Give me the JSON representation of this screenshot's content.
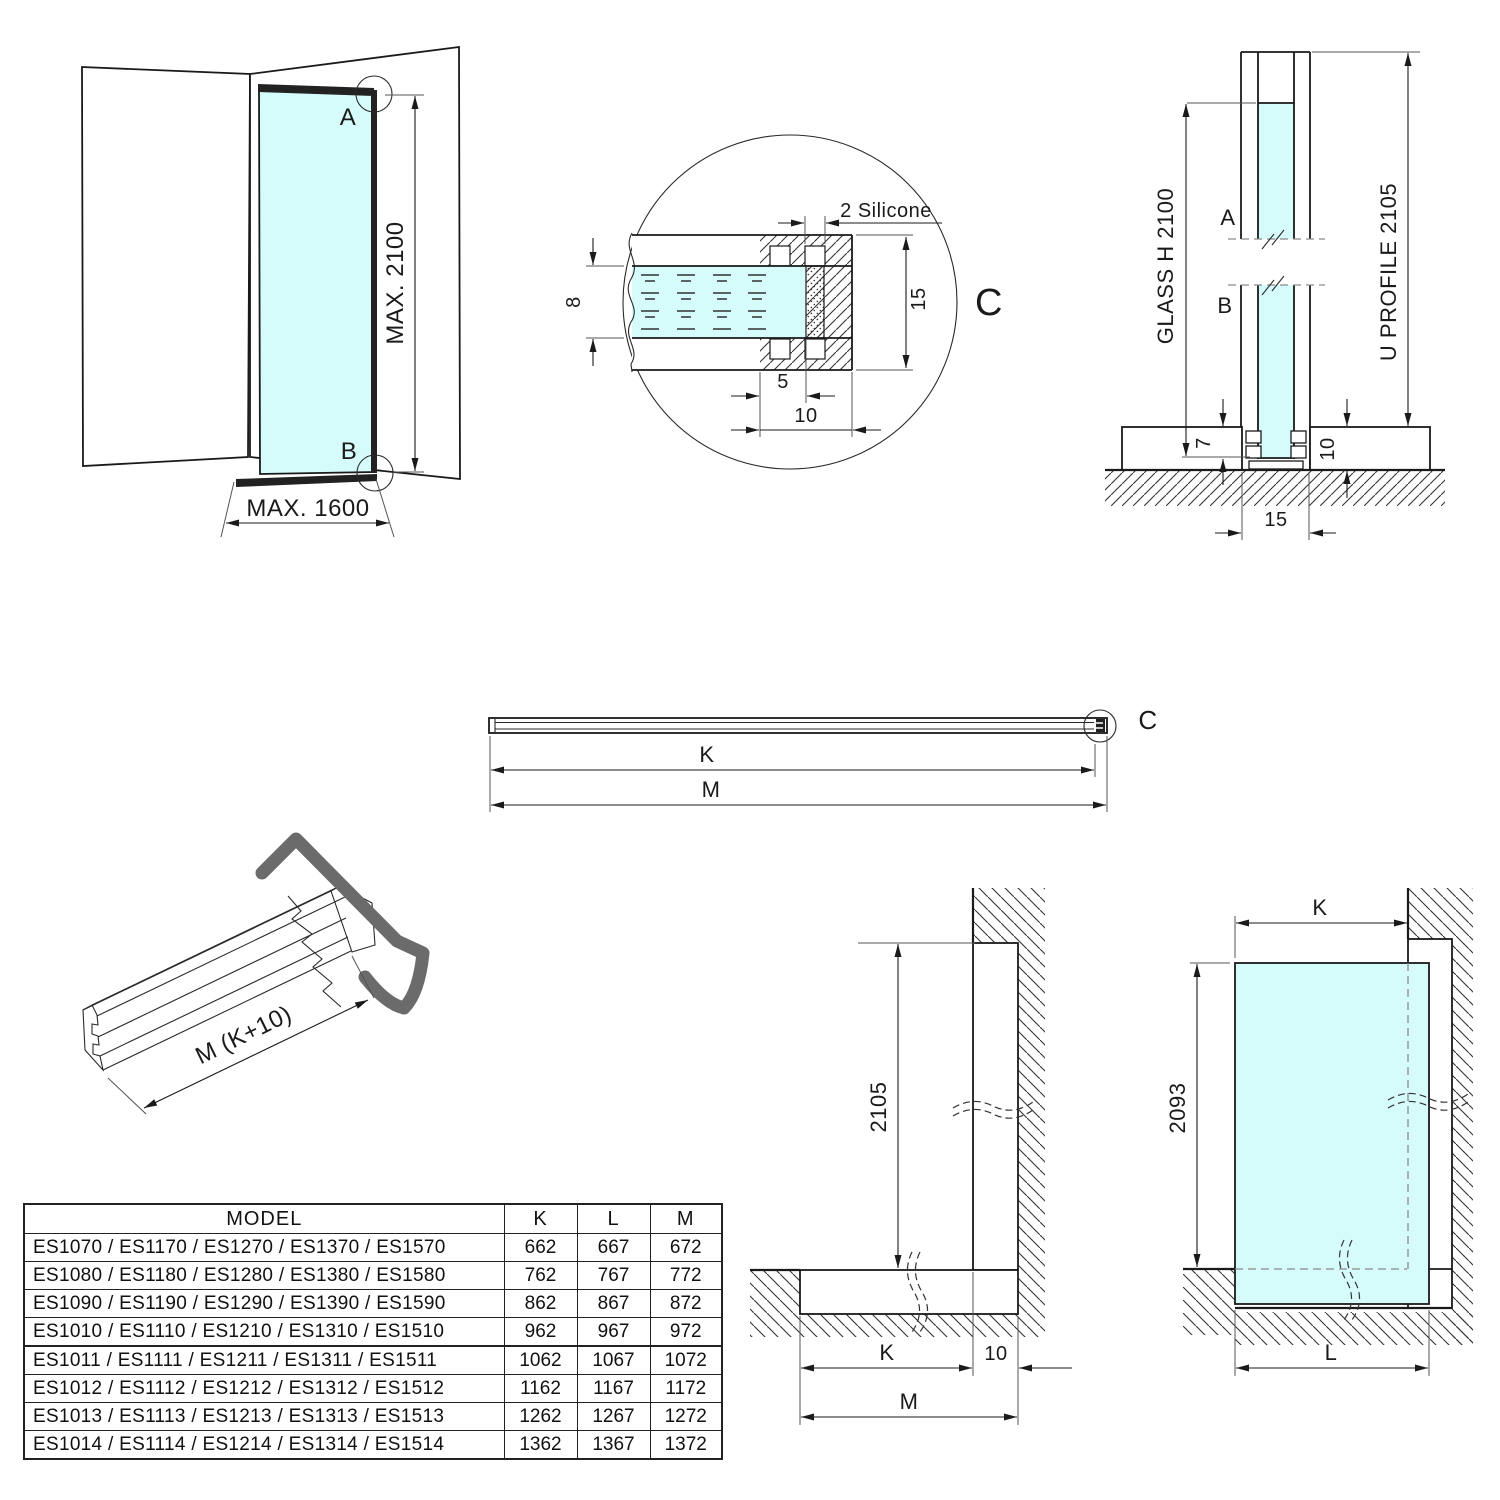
{
  "colors": {
    "glass": "#d5fbfb",
    "line": "#1a1a1a",
    "profile_gray": "#6b6b6b"
  },
  "views": {
    "corner": {
      "label_a": "A",
      "label_b": "B",
      "dim_height": "MAX. 2100",
      "dim_width": "MAX. 1600"
    },
    "detail": {
      "silicone": "2 Silicone",
      "dim_glass": "8",
      "dim_height": "15",
      "dim_inner": "5",
      "dim_outer": "10",
      "letter": "C"
    },
    "side": {
      "label_a": "A",
      "label_b": "B",
      "dim_glass": "GLASS H 2100",
      "dim_profile": "U PROFILE 2105",
      "dim_7": "7",
      "dim_10": "10",
      "dim_15": "15"
    },
    "bar": {
      "dim_k": "K",
      "dim_m": "M",
      "letter": "C"
    },
    "iso": {
      "dim_length": "M (K+10)"
    },
    "wall_section": {
      "dim_height": "2105",
      "dim_k": "K",
      "dim_10": "10",
      "dim_m": "M"
    },
    "glass_elev": {
      "dim_k": "K",
      "dim_height": "2093",
      "dim_l": "L"
    }
  },
  "table": {
    "headers": [
      "MODEL",
      "K",
      "L",
      "M"
    ],
    "rows": [
      {
        "model": "ES1070 / ES1170 / ES1270 / ES1370 / ES1570",
        "k": "662",
        "l": "667",
        "m": "672"
      },
      {
        "model": "ES1080 / ES1180 / ES1280 / ES1380 / ES1580",
        "k": "762",
        "l": "767",
        "m": "772"
      },
      {
        "model": "ES1090 / ES1190 / ES1290 / ES1390 / ES1590",
        "k": "862",
        "l": "867",
        "m": "872"
      },
      {
        "model": "ES1010 / ES1110 / ES1210 / ES1310 / ES1510",
        "k": "962",
        "l": "967",
        "m": "972"
      },
      {
        "model": "ES1011 / ES1111 / ES1211 / ES1311 / ES1511",
        "k": "1062",
        "l": "1067",
        "m": "1072"
      },
      {
        "model": "ES1012 / ES1112 / ES1212 / ES1312 / ES1512",
        "k": "1162",
        "l": "1167",
        "m": "1172"
      },
      {
        "model": "ES1013 / ES1113 / ES1213 / ES1313 / ES1513",
        "k": "1262",
        "l": "1267",
        "m": "1272"
      },
      {
        "model": "ES1014 / ES1114 / ES1214 / ES1314 / ES1514",
        "k": "1362",
        "l": "1367",
        "m": "1372"
      }
    ]
  }
}
